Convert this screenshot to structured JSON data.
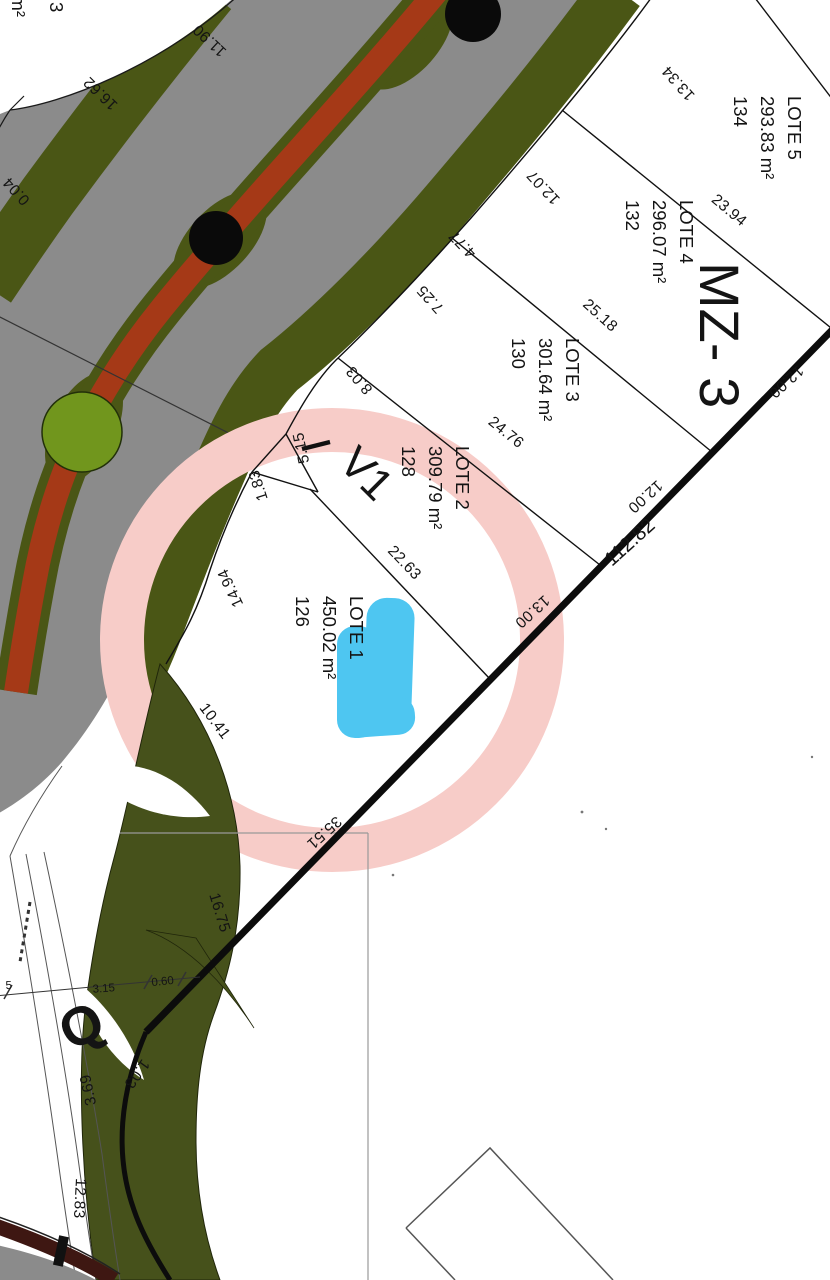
{
  "title": "Cadastral subdivision plan",
  "block": {
    "label": "MZ- 3"
  },
  "lots": [
    {
      "name": "LOTE 5",
      "area": "293.83 m²",
      "number": "134"
    },
    {
      "name": "LOTE 4",
      "area": "296.07 m²",
      "number": "132"
    },
    {
      "name": "LOTE 3",
      "area": "301.64 m²",
      "number": "130"
    },
    {
      "name": "LOTE 2",
      "area": "309.79 m²",
      "number": "128"
    },
    {
      "name": "LOTE 1",
      "area": "450.02 m²",
      "number": "126"
    }
  ],
  "v1": {
    "label": "V1"
  },
  "marker": {
    "label": "Q"
  },
  "partial_lot": {
    "number": "3",
    "area": "5 m²"
  },
  "dims": {
    "d11_90": "11.90",
    "d16_62": "16.62",
    "d0_04": "0.04",
    "d13_34": "13.34",
    "d12_07": "12.07",
    "d4_77": "4.77",
    "d7_25": "7.25",
    "d8_03": "8.03",
    "d5_15": "5.15",
    "d1_83": "1.83",
    "d14_94": "14.94",
    "d10_41": "10.41",
    "d16_75": "16.75",
    "d22_63": "22.63",
    "d23_94": "23.94",
    "d25_18": "25.18",
    "d24_76": "24.76",
    "d35_51": "35.51",
    "d13_00": "13.00",
    "d12_00_a": "12.00",
    "d12_00_b": "12.00",
    "d112_82": "112.82",
    "d12_83": "12.83",
    "d3_69": "3.69",
    "d1_03": "1.03",
    "d3_15": "3.15",
    "d0_60": "0.60",
    "d5": "5"
  },
  "colors": {
    "road_gray": "#8b8b8b",
    "strip_olive": "#4a5615",
    "park_olive": "#46511b",
    "median_red": "#a53917",
    "tree_black": "#0a0a0a",
    "glorieta_green": "#71961d",
    "highlight_pink": "#f7ccc8",
    "highlight_blue": "#3fc2f0",
    "corner_maroon": "#3e1712"
  }
}
